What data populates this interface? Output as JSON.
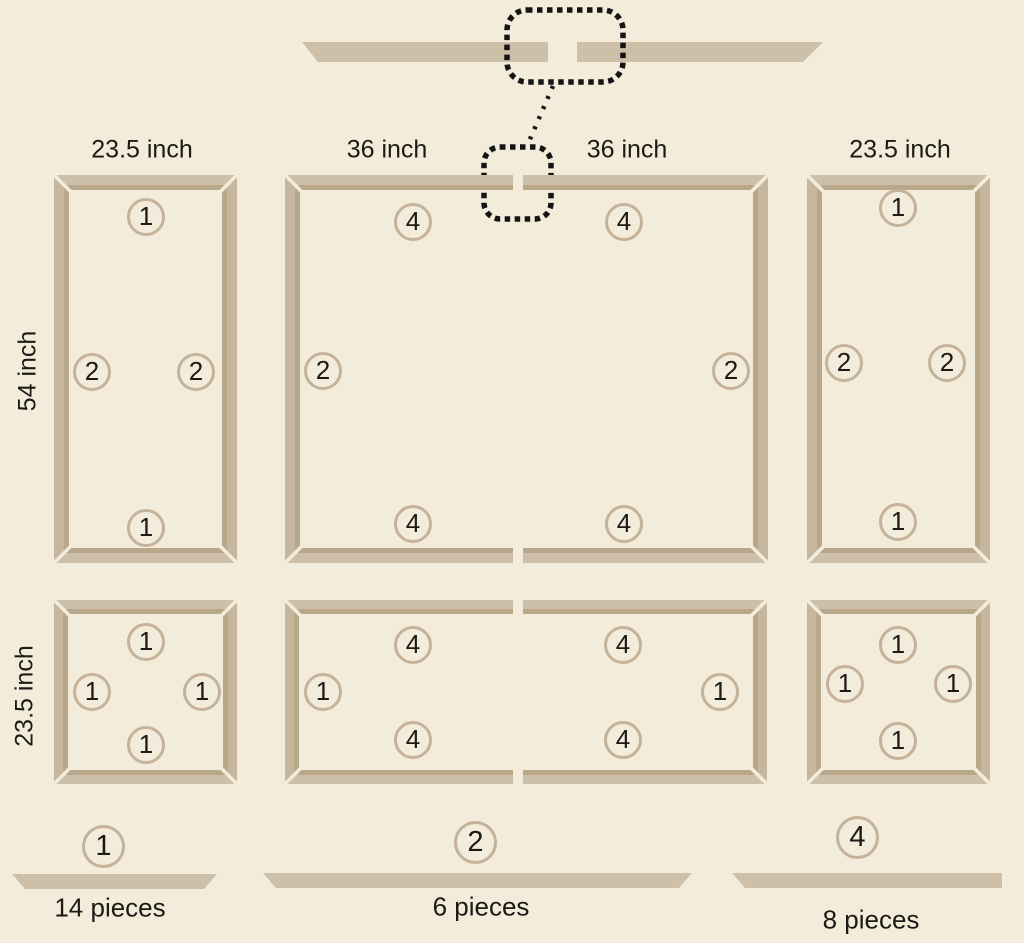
{
  "colors": {
    "background": "#f3ecda",
    "wood": "#cdbfa8",
    "wood_vertical": "#c7b69e",
    "wood_facet": "#b9a78c",
    "badge_border": "#c5b299",
    "text": "#1c1a15",
    "callout": "#151515"
  },
  "assembly_detail": {
    "description_pieces": [
      {
        "points": "302,42 548,42 548,62 318,62"
      },
      {
        "points": "577,42 823,42 803,62 577,62"
      }
    ],
    "callout_large": {
      "x": 507,
      "y": 10,
      "w": 116,
      "h": 72,
      "r": 20
    },
    "callout_small": {
      "x": 484,
      "y": 147,
      "w": 67,
      "h": 72,
      "r": 16
    },
    "connector": {
      "x1": 553,
      "y1": 86,
      "x2": 527,
      "y2": 146
    }
  },
  "dimension_labels": [
    {
      "text": "23.5 inch",
      "x": 142,
      "y": 150,
      "rotate": false
    },
    {
      "text": "36 inch",
      "x": 387,
      "y": 150,
      "rotate": false
    },
    {
      "text": "36 inch",
      "x": 627,
      "y": 150,
      "rotate": false
    },
    {
      "text": "23.5 inch",
      "x": 900,
      "y": 150,
      "rotate": false
    },
    {
      "text": "54 inch",
      "x": 28,
      "y": 371,
      "rotate": true
    },
    {
      "text": "23.5 inch",
      "x": 25,
      "y": 696,
      "rotate": true
    }
  ],
  "frames": [
    {
      "name": "panel-top-left",
      "x": 54,
      "y": 175,
      "w": 183,
      "h": 388,
      "t": 15,
      "badges": [
        {
          "n": "1",
          "x": 146,
          "y": 217
        },
        {
          "n": "2",
          "x": 92,
          "y": 372
        },
        {
          "n": "2",
          "x": 196,
          "y": 372
        },
        {
          "n": "1",
          "x": 146,
          "y": 528
        }
      ]
    },
    {
      "name": "panel-top-middle",
      "x": 285,
      "y": 175,
      "w": 483,
      "h": 388,
      "t": 15,
      "split_top": true,
      "split_bottom": true,
      "split_x": 518,
      "badges": [
        {
          "n": "4",
          "x": 413,
          "y": 222
        },
        {
          "n": "4",
          "x": 624,
          "y": 222
        },
        {
          "n": "2",
          "x": 323,
          "y": 371
        },
        {
          "n": "2",
          "x": 731,
          "y": 371
        },
        {
          "n": "4",
          "x": 413,
          "y": 524
        },
        {
          "n": "4",
          "x": 624,
          "y": 524
        }
      ]
    },
    {
      "name": "panel-top-right",
      "x": 807,
      "y": 175,
      "w": 183,
      "h": 388,
      "t": 15,
      "badges": [
        {
          "n": "1",
          "x": 898,
          "y": 208
        },
        {
          "n": "2",
          "x": 844,
          "y": 363
        },
        {
          "n": "2",
          "x": 947,
          "y": 363
        },
        {
          "n": "1",
          "x": 898,
          "y": 522
        }
      ]
    },
    {
      "name": "panel-bottom-left",
      "x": 54,
      "y": 600,
      "w": 183,
      "h": 184,
      "t": 14,
      "badges": [
        {
          "n": "1",
          "x": 146,
          "y": 642
        },
        {
          "n": "1",
          "x": 92,
          "y": 692
        },
        {
          "n": "1",
          "x": 202,
          "y": 692
        },
        {
          "n": "1",
          "x": 146,
          "y": 745
        }
      ]
    },
    {
      "name": "panel-bottom-middle",
      "x": 285,
      "y": 600,
      "w": 482,
      "h": 184,
      "t": 14,
      "split_top": true,
      "split_bottom": true,
      "split_x": 518,
      "badges": [
        {
          "n": "4",
          "x": 413,
          "y": 645
        },
        {
          "n": "4",
          "x": 623,
          "y": 645
        },
        {
          "n": "1",
          "x": 323,
          "y": 692
        },
        {
          "n": "1",
          "x": 720,
          "y": 692
        },
        {
          "n": "4",
          "x": 413,
          "y": 740
        },
        {
          "n": "4",
          "x": 623,
          "y": 740
        }
      ]
    },
    {
      "name": "panel-bottom-right",
      "x": 807,
      "y": 600,
      "w": 183,
      "h": 184,
      "t": 14,
      "badges": [
        {
          "n": "1",
          "x": 898,
          "y": 645
        },
        {
          "n": "1",
          "x": 845,
          "y": 684
        },
        {
          "n": "1",
          "x": 953,
          "y": 684
        },
        {
          "n": "1",
          "x": 898,
          "y": 741
        }
      ]
    }
  ],
  "legend": {
    "items": [
      {
        "number": "1",
        "count_label": "14 pieces",
        "circle": {
          "x": 103,
          "y": 846
        },
        "bar_points": "12,874 217,874 204,889 25,889",
        "label_pos": {
          "x": 110,
          "y": 908
        }
      },
      {
        "number": "2",
        "count_label": "6 pieces",
        "circle": {
          "x": 475,
          "y": 842
        },
        "bar_points": "263,873 692,873 679,888 276,888",
        "label_pos": {
          "x": 481,
          "y": 907
        }
      },
      {
        "number": "4",
        "count_label": "8 pieces",
        "circle": {
          "x": 857,
          "y": 837
        },
        "bar_points": "732,873 1002,873 1002,888 745,888",
        "label_pos": {
          "x": 871,
          "y": 920
        }
      }
    ]
  }
}
